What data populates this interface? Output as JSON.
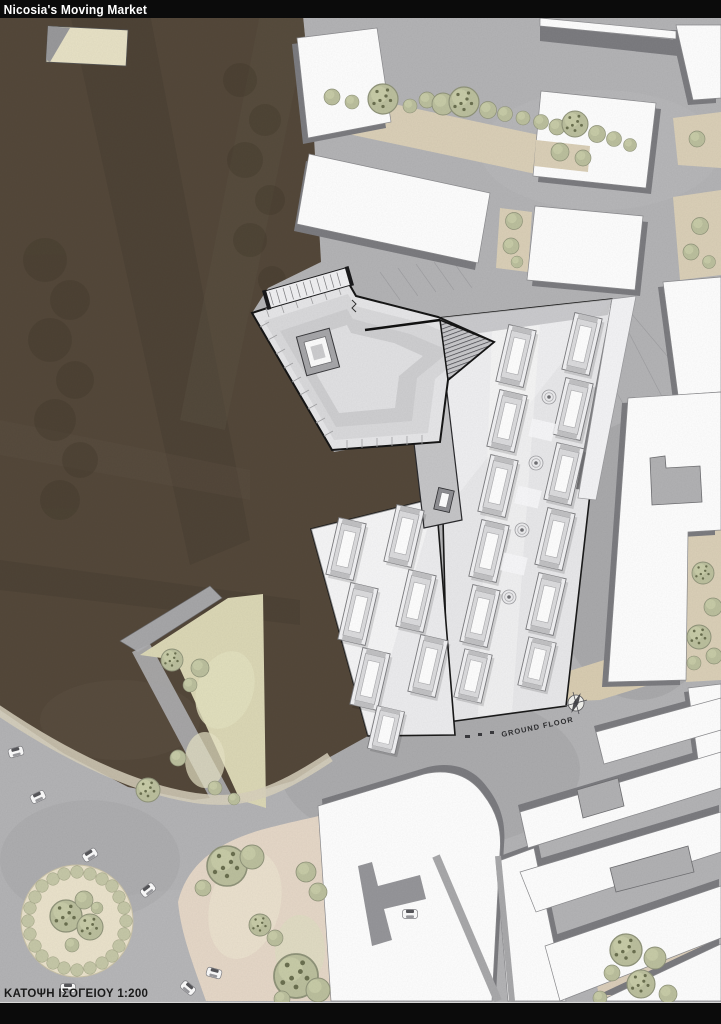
{
  "window": {
    "title": "Nicosia's Moving Market"
  },
  "plan": {
    "name": "nicosia-moving-market-site-plan",
    "labels": {
      "ground_floor": "GROUND FLOOR"
    },
    "scale_label": "ΚΑΤΟΨΗ ΙΣΟΓΕΙΟΥ 1:200",
    "palette": {
      "street_gray": "#b4b4b6",
      "moat_brown": "#54483a",
      "building_white": "#ffffff",
      "building_shadow": "#7c7c80",
      "pavement_beige": "#dbd0b8",
      "park_beige": "#e6d8c8",
      "courtyard_green": "#dcd8b6",
      "tree_olive": "#bcc09e",
      "roof_light_gray": "#e7e7e9",
      "outline_black": "#161616",
      "titlebar_black": "#0b0b0b",
      "plaza_cream": "#ebe3cc"
    },
    "icons": [
      "north-compass-icon",
      "tree-icon",
      "car-icon",
      "drain-icon",
      "market-stall-icon",
      "skylight-icon",
      "stairs-icon"
    ]
  }
}
